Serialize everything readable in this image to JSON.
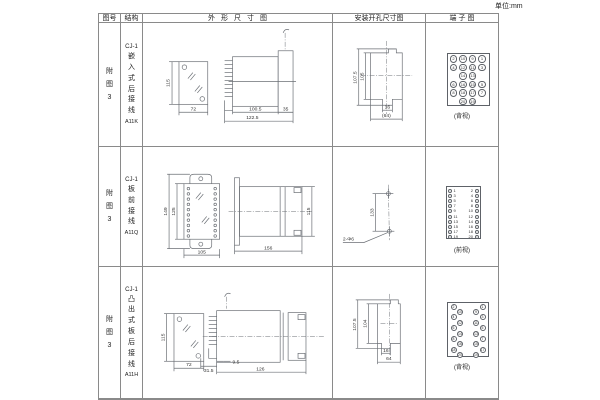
{
  "page": {
    "unit": "单位:mm"
  },
  "headers": {
    "fig": "图号",
    "structure": "结构",
    "outline": "外形尺寸图",
    "install": "安装开孔尺寸图",
    "terminal": "端子图"
  },
  "rows": [
    {
      "fig": "附图3",
      "model": "CJ-1",
      "desc": "嵌入式后接线",
      "code": "A11K",
      "dims": {
        "h": "115",
        "w": "72",
        "d1": "100.5",
        "d2": "122.5",
        "d3": "35"
      },
      "install": {
        "v1": "107.5",
        "v2": "105",
        "b1": "16",
        "b2": "(64)"
      },
      "terminal": {
        "label": "(背视)",
        "view": "back",
        "rows": [
          [
            2,
            10,
            9,
            1
          ],
          [
            4,
            12,
            11,
            3
          ],
          [
            null,
            14,
            13,
            null
          ],
          [
            6,
            16,
            15,
            5
          ],
          [
            8,
            18,
            17,
            7
          ],
          [
            null,
            20,
            19,
            null
          ]
        ]
      }
    },
    {
      "fig": "附图3",
      "model": "CJ-1",
      "desc": "板前接线",
      "code": "A11Q",
      "dims": {
        "h1": "149",
        "h2": "125",
        "w": "105",
        "d": "156",
        "sh": "115"
      },
      "install": {
        "v": "133",
        "note": "2-Φ6"
      },
      "terminal": {
        "label": "(前视)",
        "view": "front",
        "left": [
          1,
          3,
          5,
          7,
          9,
          11,
          13,
          15,
          17,
          19
        ],
        "right": [
          2,
          4,
          6,
          8,
          10,
          12,
          14,
          16,
          18,
          20
        ]
      }
    },
    {
      "fig": "附图3",
      "model": "CJ-1",
      "desc": "凸出式板后接线",
      "code": "A11H",
      "dims": {
        "h": "115",
        "w": "72",
        "d1": "31.5",
        "d2": "9.5",
        "d3": "126"
      },
      "install": {
        "v1": "107.5",
        "v2": "104",
        "b1": "16",
        "b2": "64"
      },
      "terminal": {
        "label": "(背视)",
        "view": "stagger",
        "left": [
          2,
          10,
          4,
          12,
          6,
          14,
          8,
          16,
          18,
          20
        ],
        "right": [
          1,
          9,
          3,
          11,
          5,
          13,
          7,
          15,
          17,
          19
        ]
      }
    }
  ]
}
